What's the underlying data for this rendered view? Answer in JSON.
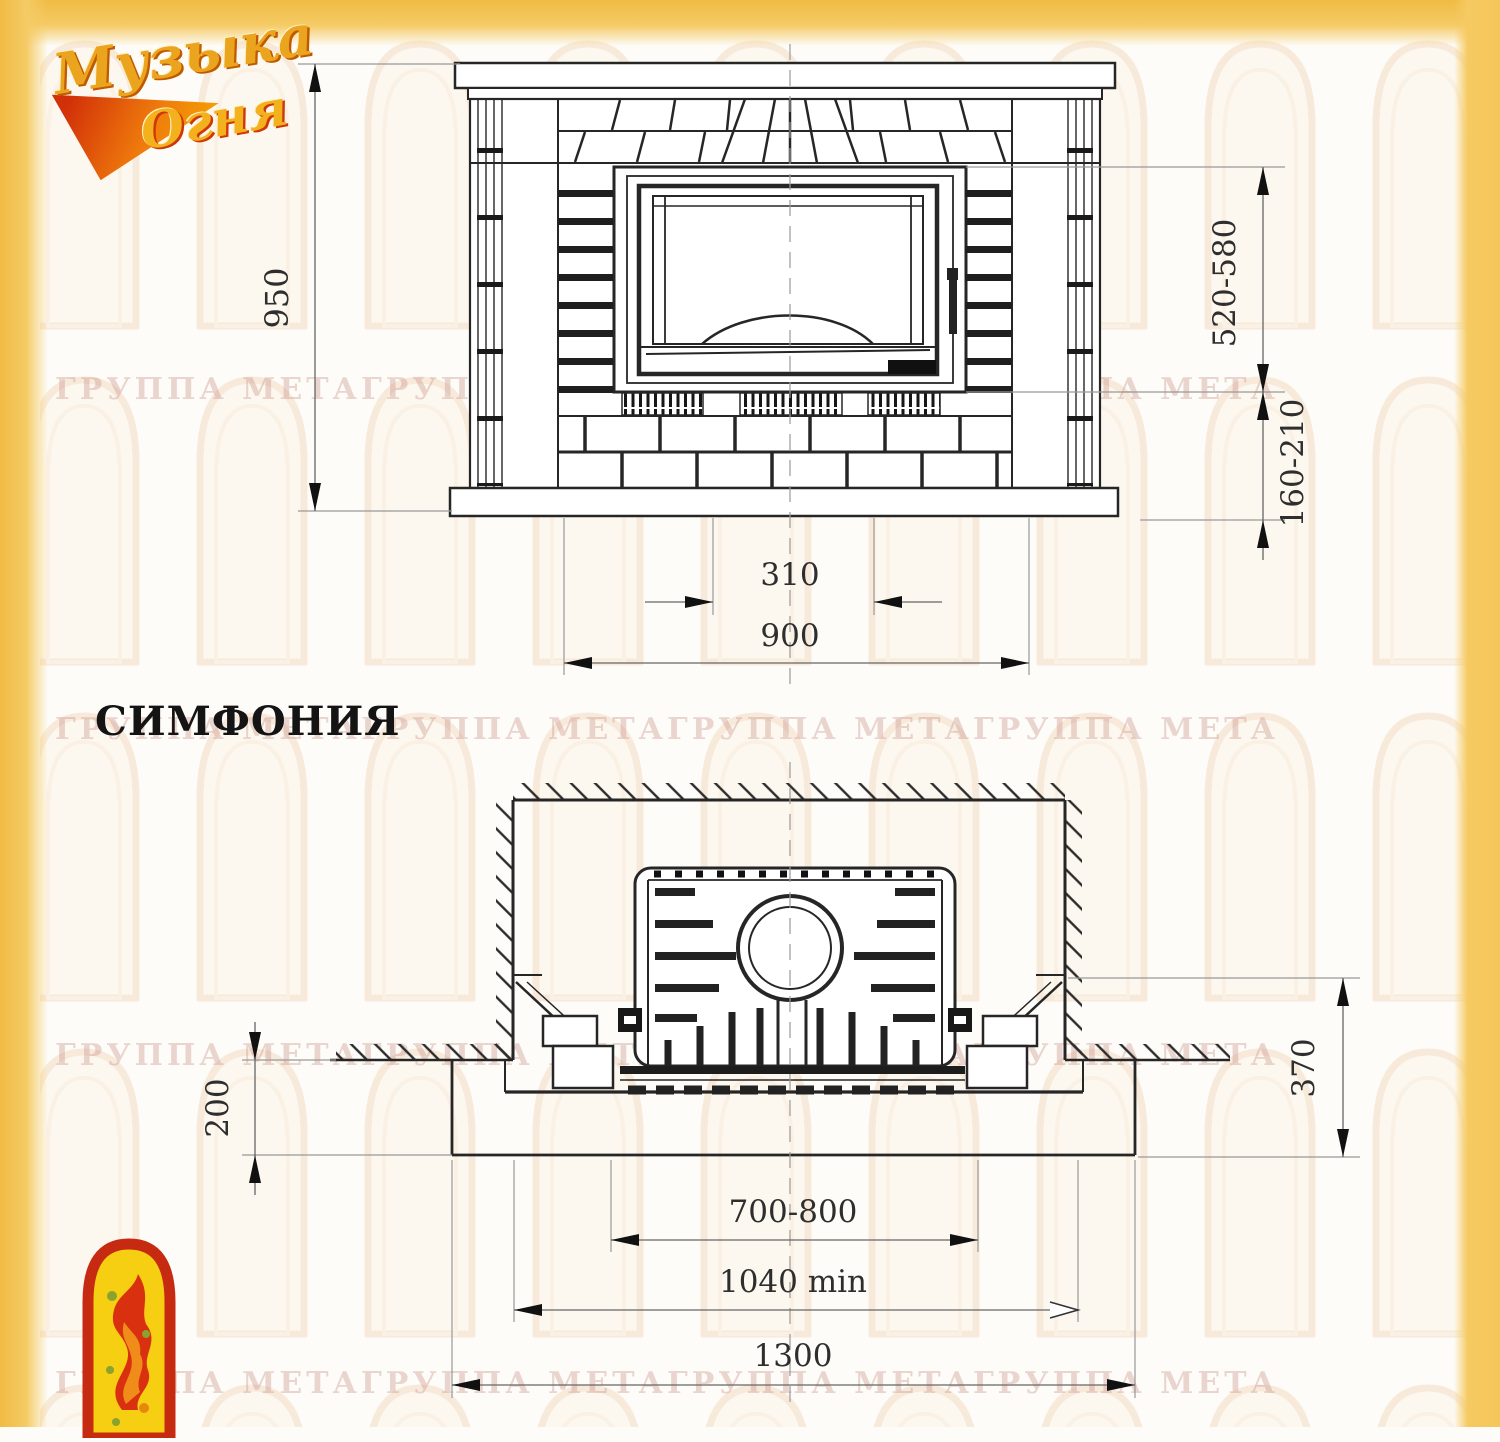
{
  "logo": {
    "word1": "Музыка",
    "word2": "Огня"
  },
  "title": "СИМФОНИЯ",
  "watermark_text": "ГРУППА МЕТАГРУППА МЕТАГРУППА МЕТАГРУППА МЕТА",
  "colors": {
    "frame_yellow": "#f2c053",
    "line_dark": "#262626",
    "emblem_red": "#c62a10",
    "emblem_yellow": "#f6cf13"
  },
  "dims": {
    "front": {
      "height": "950",
      "glass": "520-580",
      "hearth": "160-210",
      "opening": "310",
      "width": "900"
    },
    "plan": {
      "slab": "200",
      "depth": "370",
      "insert": "700-800",
      "min_niche": "1040 min",
      "base": "1300"
    }
  }
}
